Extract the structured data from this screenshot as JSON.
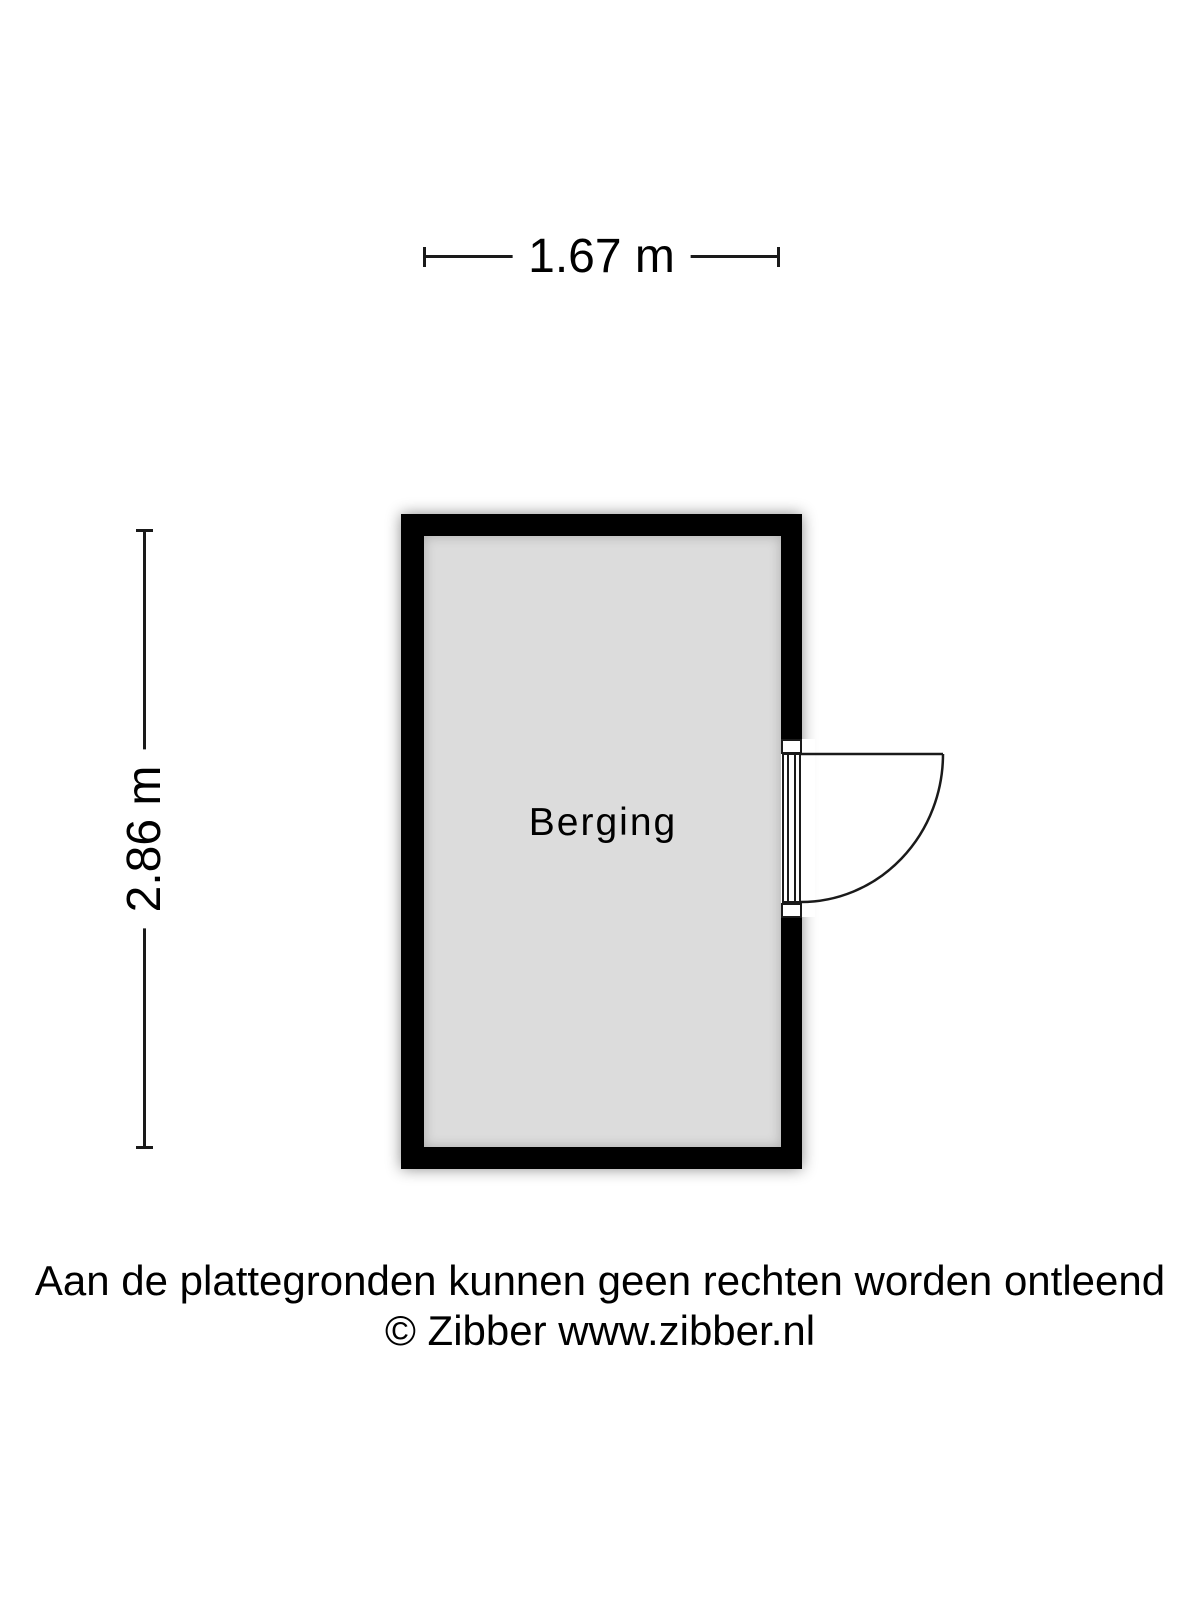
{
  "dimensions": {
    "width": {
      "label": "1.67 m"
    },
    "height": {
      "label": "2.86 m"
    }
  },
  "room": {
    "name": "Berging"
  },
  "footer": {
    "disclaimer": "Aan de plattegronden kunnen geen rechten worden ontleend",
    "copyright": "© Zibber www.zibber.nl"
  },
  "colors": {
    "wall": "#000000",
    "floor": "#dcdcdc",
    "text": "#000000",
    "line": "#1a1a1a",
    "background": "#ffffff"
  }
}
